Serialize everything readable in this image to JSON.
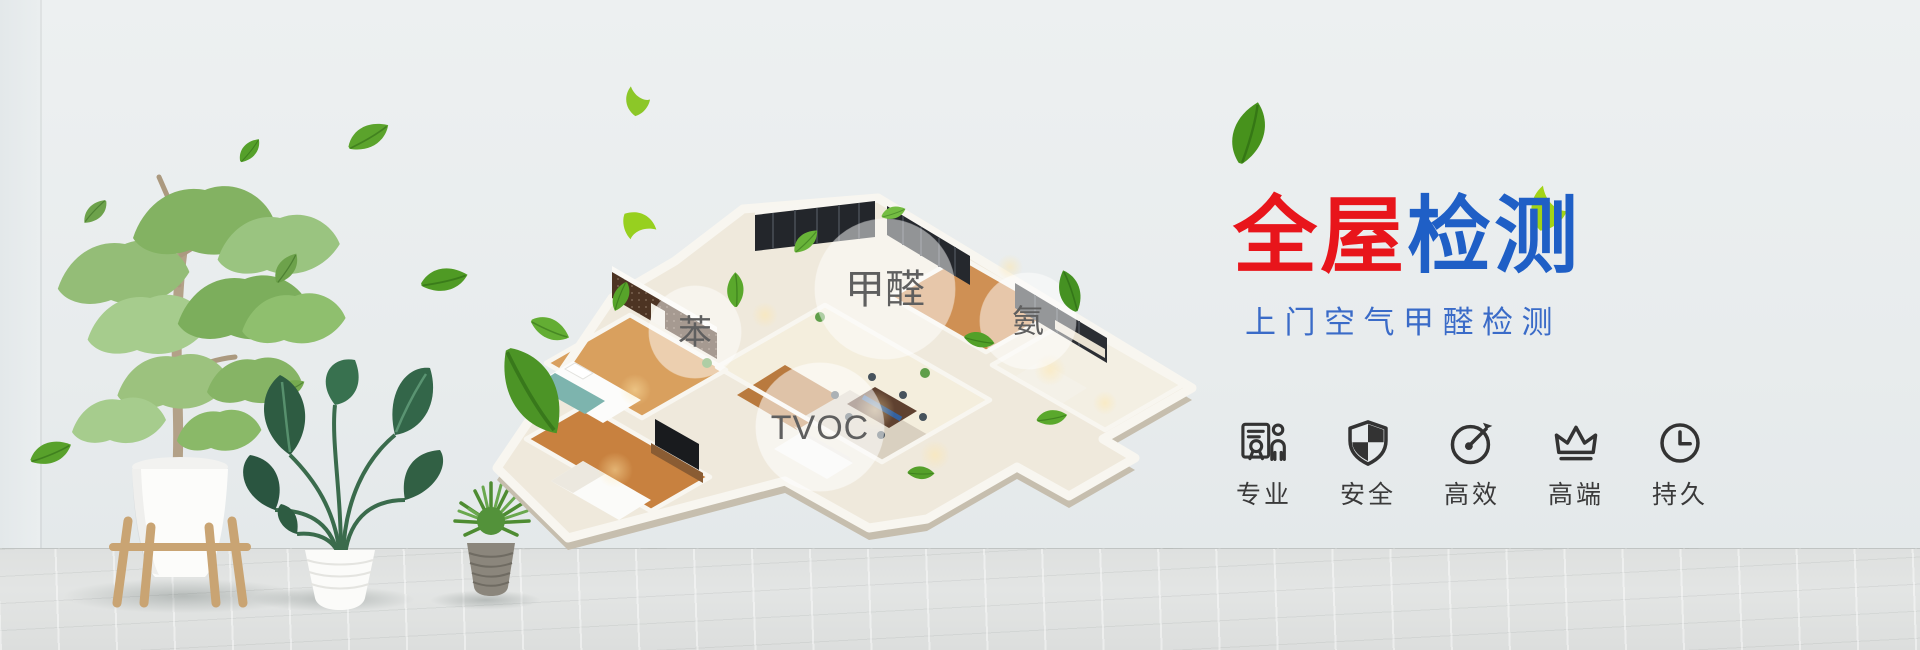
{
  "banner": {
    "headline": {
      "primary": "全屋",
      "secondary": "检测"
    },
    "subtitle": "上门空气甲醛检测",
    "pollutants": {
      "benzene": "苯",
      "formaldehyde": "甲醛",
      "ammonia": "氨",
      "tvoc": "TVOC"
    },
    "features": [
      {
        "icon": "badge-person-icon",
        "label": "专业"
      },
      {
        "icon": "shield-icon",
        "label": "安全"
      },
      {
        "icon": "gauge-icon",
        "label": "高效"
      },
      {
        "icon": "crown-icon",
        "label": "高端"
      },
      {
        "icon": "clock-icon",
        "label": "持久"
      }
    ],
    "colors": {
      "headline_red": "#e8151b",
      "headline_blue": "#1f5fc6",
      "subtitle_blue": "#3a6bc8",
      "icon_ink": "#333333",
      "leaf_green": "#5aa32b",
      "wall_gray": "#e8eced",
      "floor_gray": "#e0e2e1"
    }
  }
}
